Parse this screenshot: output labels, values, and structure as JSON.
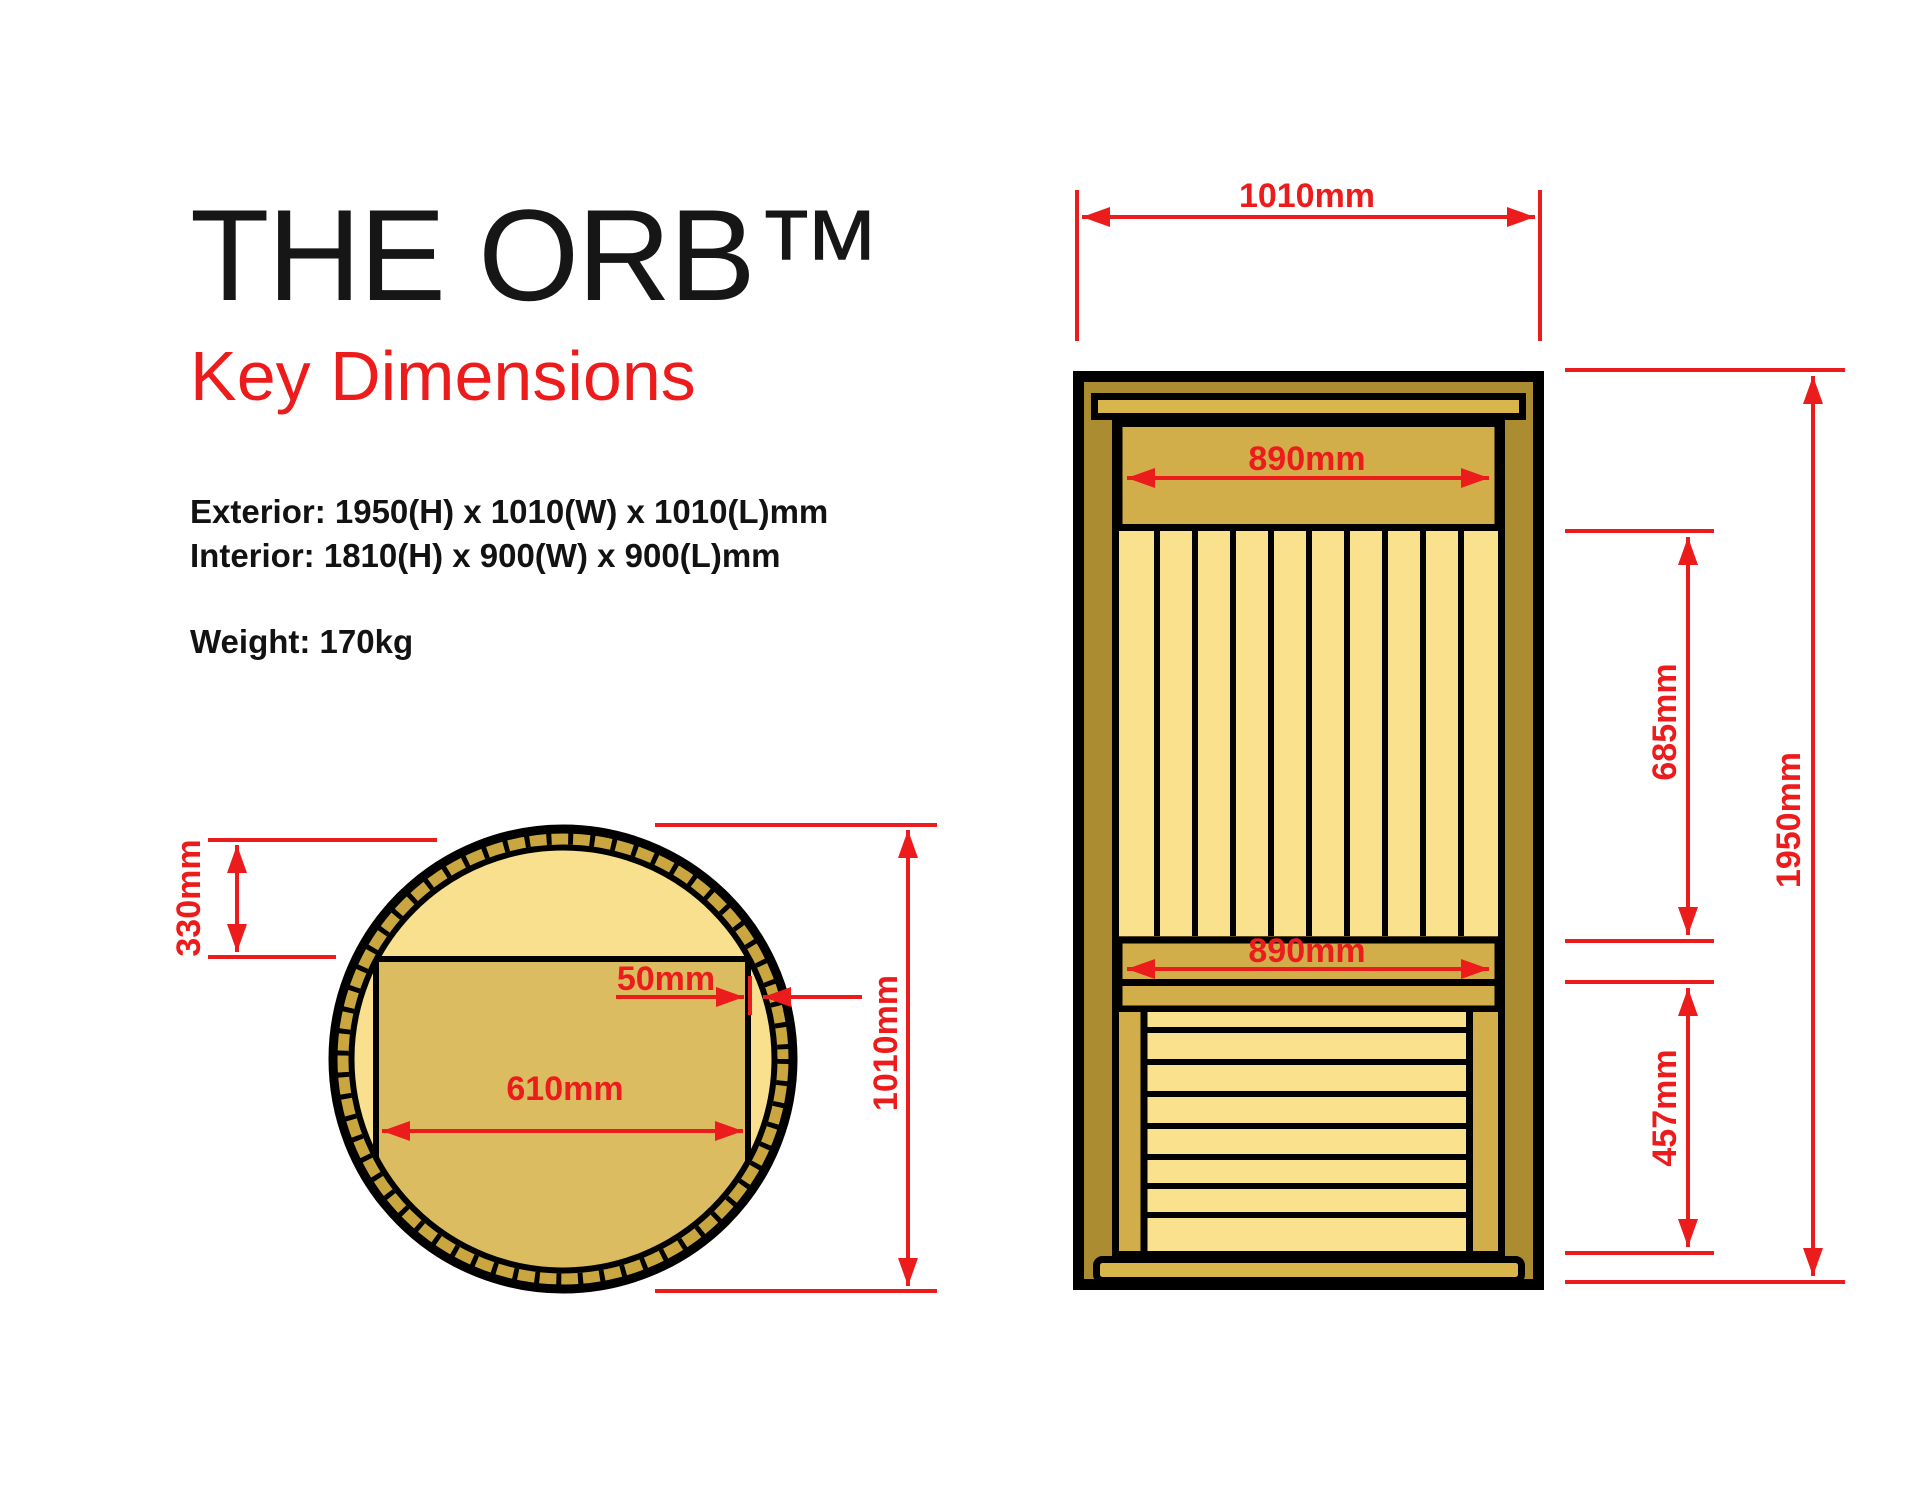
{
  "header": {
    "title": "THE ORB™",
    "subtitle": "Key Dimensions",
    "spec_exterior": "Exterior: 1950(H) x 1010(W) x 1010(L)mm",
    "spec_interior": "Interior: 1810(H) x 900(W) x 900(L)mm",
    "weight": "Weight: 170kg"
  },
  "top_view": {
    "name": "top view (plan) of barrel sauna",
    "dim_depth": "330mm",
    "dim_gap": "50mm",
    "dim_bench_width": "610mm",
    "dim_diameter": "1010mm"
  },
  "front_view": {
    "name": "front elevation of sauna",
    "dim_width": "1010mm",
    "dim_panel_top": "890mm",
    "dim_panel_mid": "890mm",
    "dim_slats_height": "685mm",
    "dim_total_height": "1950mm",
    "dim_bench_height": "457mm"
  },
  "colors": {
    "accent_red": "#ED1C1C",
    "frame_dark_gold": "#AB8C31",
    "band_gold": "#D2AE4B",
    "trim_gold": "#D9B64C",
    "slat_light": "#F9E18E",
    "ring_gold": "#C9A63F",
    "disc_light": "#F8E08E",
    "bench_tan": "#DCBC60",
    "outline_black": "#000000"
  }
}
